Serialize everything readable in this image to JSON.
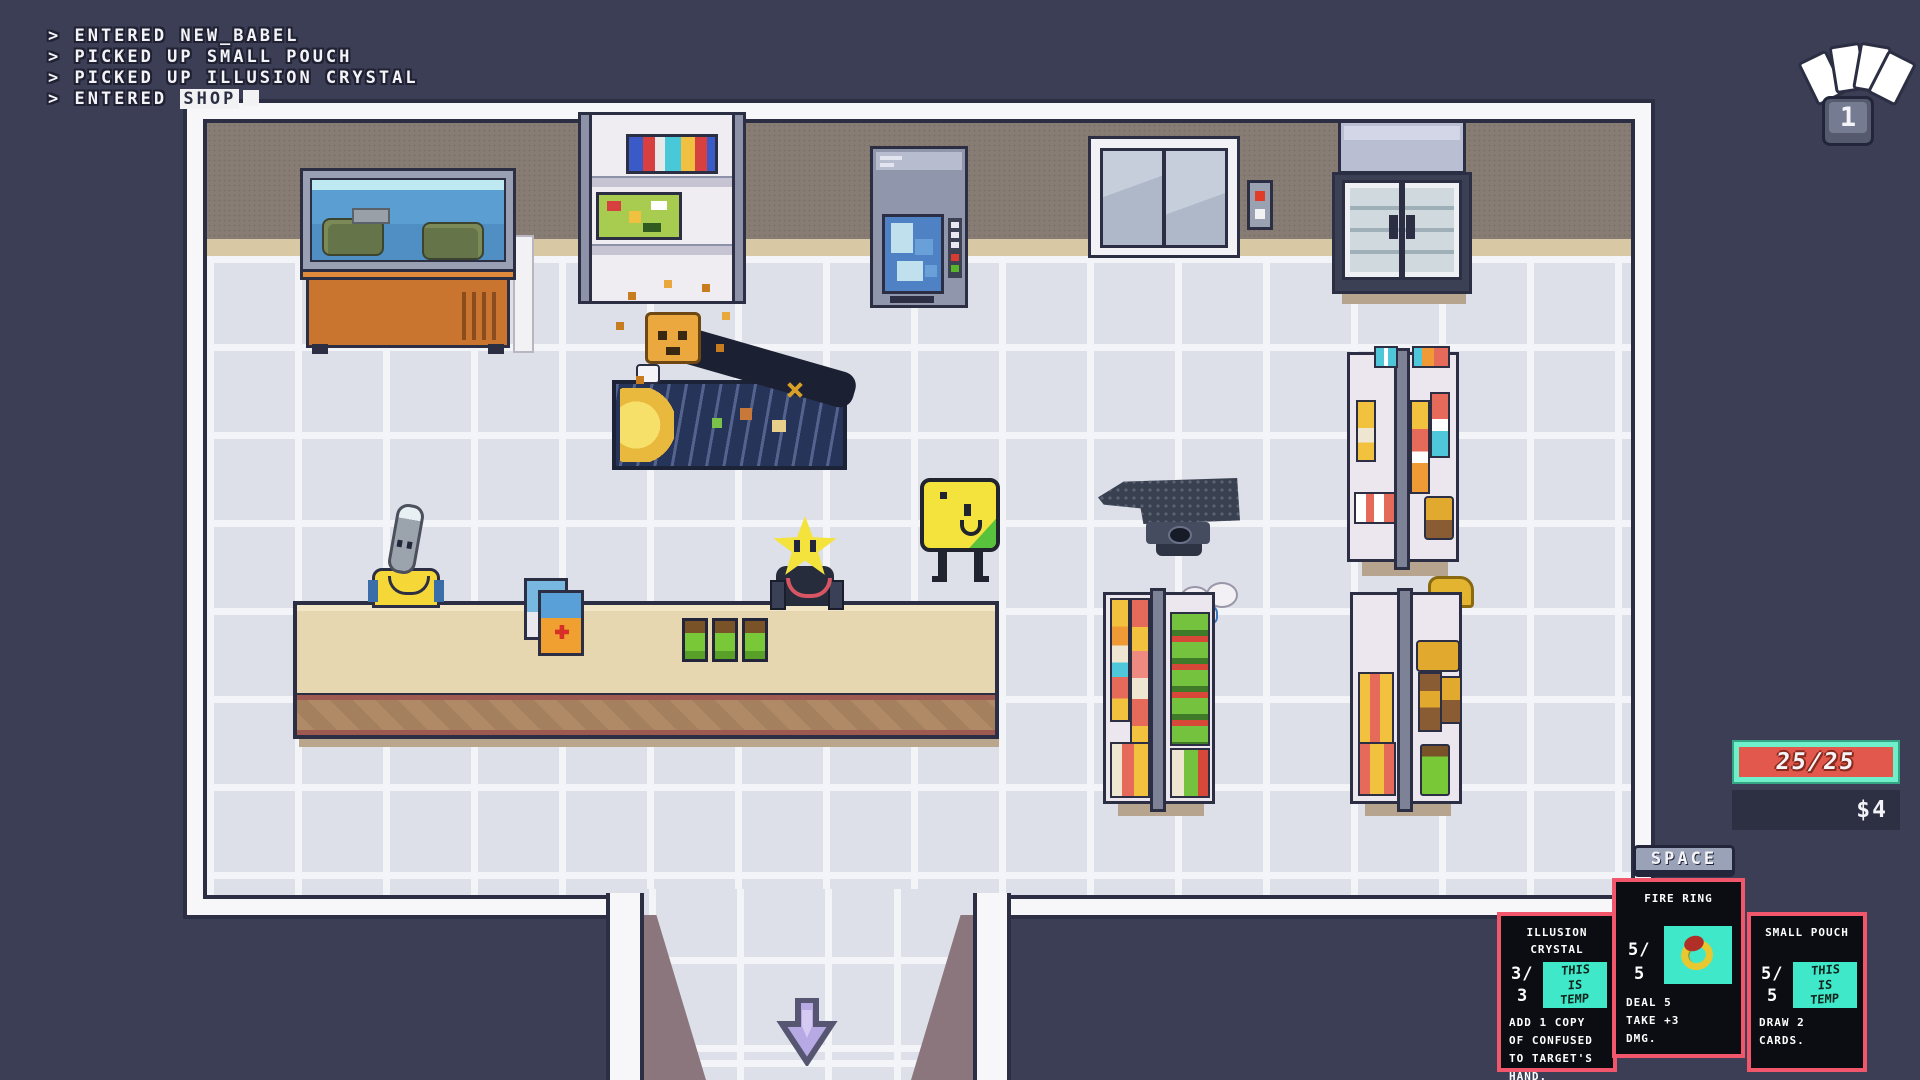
{
  "log": {
    "lines": [
      "> ENTERED NEW_BABEL",
      "> PICKED UP SMALL POUCH",
      "> PICKED UP ILLUSION CRYSTAL"
    ],
    "current_prefix": "> ENTERED ",
    "current_highlight": "SHOP"
  },
  "hand": {
    "key_label": "1"
  },
  "hud": {
    "hp": "25/25",
    "money": "$4"
  },
  "action_key": {
    "label": "SPACE"
  },
  "cards": [
    {
      "title": "ILLUSION\nCRYSTAL",
      "cost_top": "3/",
      "cost_bottom": "3",
      "art_text": "THIS\nIS\nTEMP",
      "description": "ADD 1 COPY\nOF CONFUSED\nTO TARGET'S\nHAND."
    },
    {
      "title": "FIRE RING",
      "cost_top": "5/",
      "cost_bottom": "5",
      "art_text": "",
      "description": "DEAL 5\nTAKE +3\nDMG."
    },
    {
      "title": "SMALL POUCH",
      "cost_top": "5/",
      "cost_bottom": "5",
      "art_text": "THIS\nIS\nTEMP",
      "description": "DRAW 2\nCARDS."
    }
  ],
  "colors": {
    "background": "#3b3e54",
    "hp_fill": "#e2584c",
    "hp_border": "#6ff0cb",
    "money_panel": "#2d3043",
    "card_border": "#f2566a",
    "card_art_bg": "#3ee8c8",
    "exit_arrow": "#b7a9e4",
    "keycap": "#9aa2b8"
  },
  "icons": {
    "hand_indicator": "card-fan-icon",
    "exit": "down-arrow-icon"
  }
}
